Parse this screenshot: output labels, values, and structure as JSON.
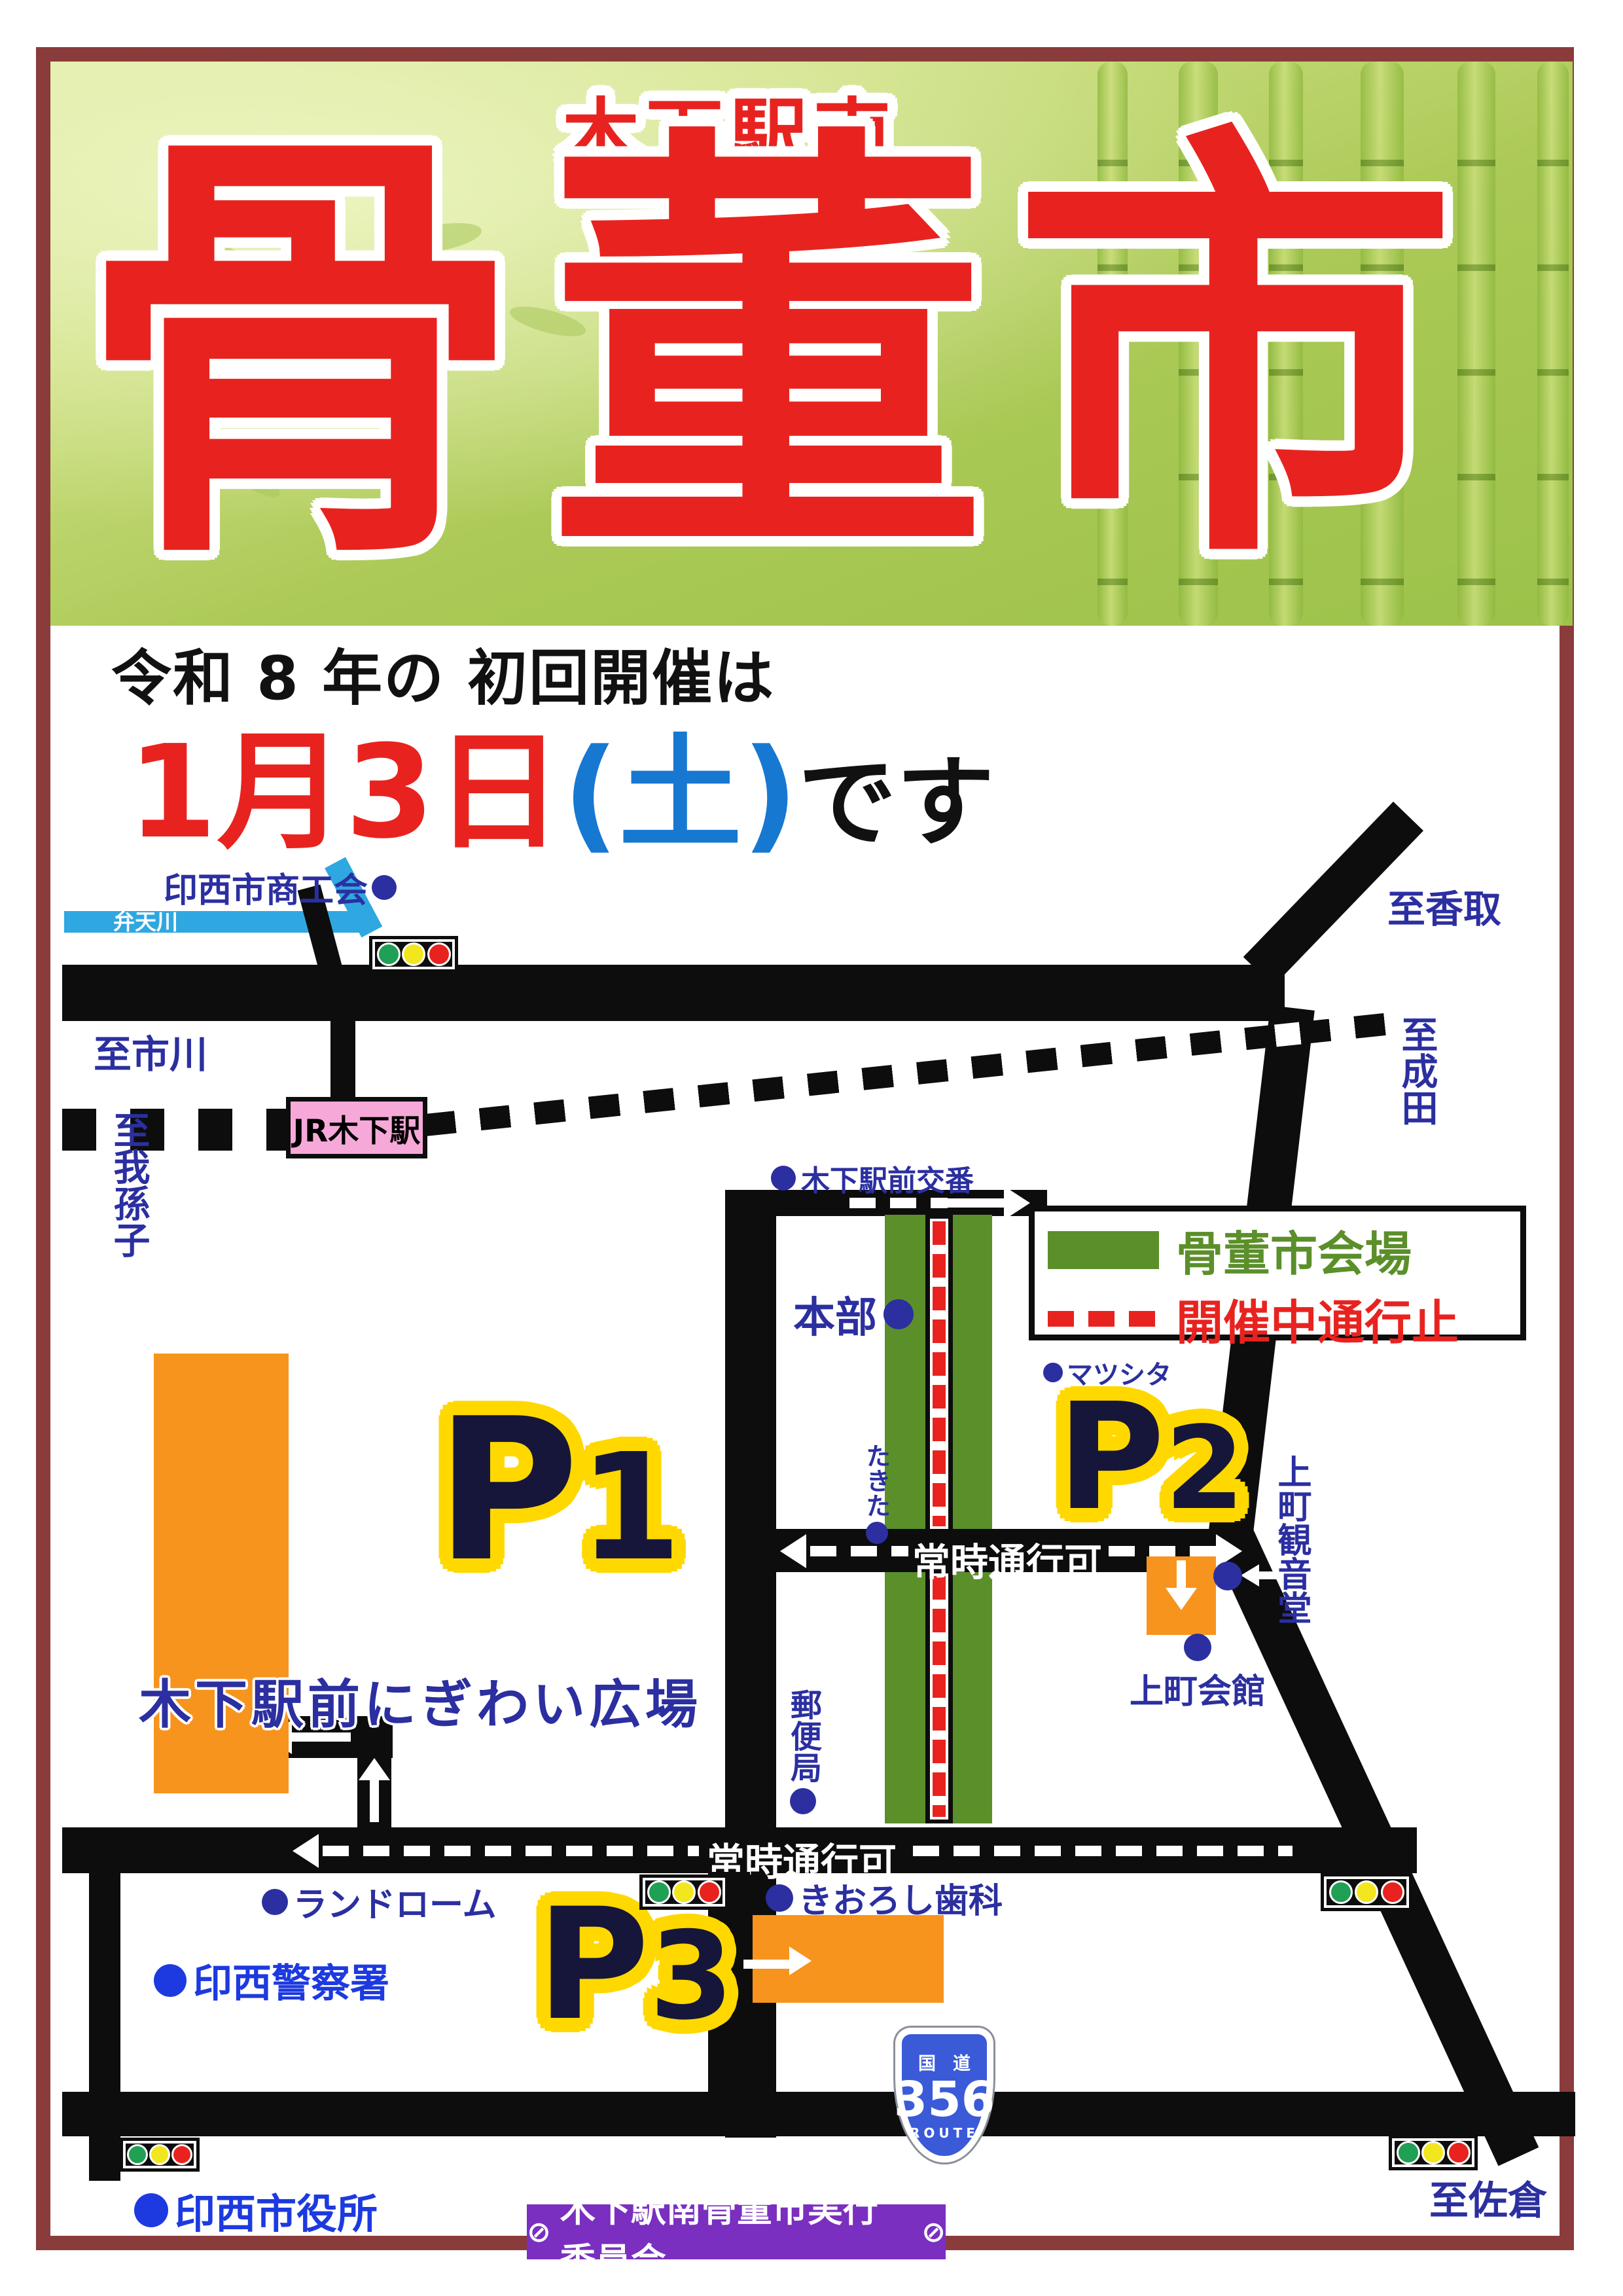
{
  "poster": {
    "title_small": "木下駅南",
    "title_main": "骨董市"
  },
  "announcement": {
    "line1": "令和 8 年の 初回開催は",
    "date": "1月3日",
    "weekday": "(土)",
    "suffix": "です"
  },
  "legend": {
    "venue_label": "骨董市会場",
    "closed_label": "開催中通行止"
  },
  "map": {
    "river": "弁天川",
    "chamber": "印西市商工会",
    "to_ichikawa": "至市川",
    "to_abiko": "至我孫子",
    "to_katori": "至香取",
    "to_narita": "至成田",
    "to_sakura": "至佐倉",
    "station": "JR木下駅",
    "koban": "木下駅前交番",
    "headquarters": "本部",
    "matsushita": "マツシタ",
    "takita": "たきた",
    "post_office": "郵便局",
    "passable_upper": "常時通行可",
    "passable_lower": "常時通行可",
    "kanondo": "上町観音堂",
    "kaikan": "上町会館",
    "dental": "きおろし歯科",
    "landrome": "ランドローム",
    "police": "印西警察署",
    "city_hall": "印西市役所"
  },
  "parking": {
    "p1": {
      "letter": "P",
      "number": "1",
      "name": "木下駅前にぎわい広場"
    },
    "p2": {
      "letter": "P",
      "number": "2"
    },
    "p3": {
      "letter": "P",
      "number": "3"
    }
  },
  "route_sign": {
    "kokudo": "国道",
    "number": "356",
    "route": "ROUTE"
  },
  "footer": {
    "symbol_left": "⊘",
    "text": "木下駅南骨董市実行委員会",
    "symbol_right": "⊘"
  },
  "colors": {
    "red": "#e8231f",
    "green": "#5b8f2a",
    "label_blue": "#2b2fa0",
    "orange": "#f7941d",
    "halo_yellow": "#ffd800",
    "river_cyan": "#2fa7e0",
    "station_pink": "#f6a9d9",
    "footer_purple": "#7a2fc0",
    "frame_maroon": "#8a3b3b",
    "weekday_blue": "#1778d2"
  }
}
